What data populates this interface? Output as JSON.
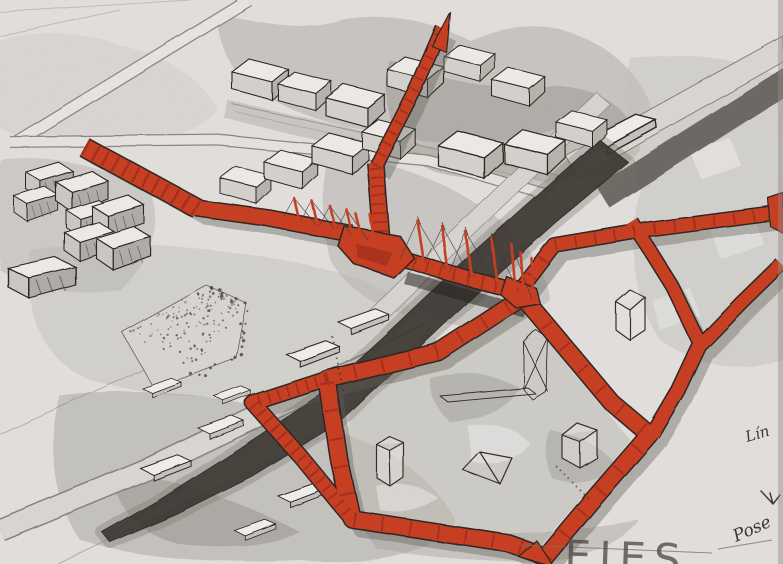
{
  "annotations": {
    "linea_label": "Lín",
    "script_note": "Pose",
    "title_lettering": "EJES"
  },
  "colors": {
    "paper": "#e7e5e2",
    "route_red": "#cc3a1e",
    "route_red_deep": "#9a2711",
    "ink": "#26221c",
    "canal": "#38342e",
    "wash_light": "#c8c6c0",
    "wash_mid": "#aaa7a1",
    "wash_dark": "#8b8880",
    "shadow": "#5e5b54",
    "pencil": "#6b6862"
  }
}
